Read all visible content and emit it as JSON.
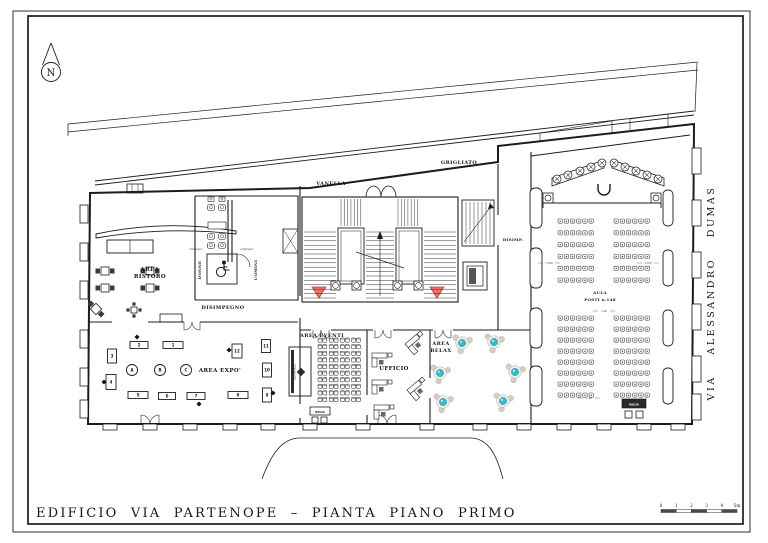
{
  "page": {
    "title": "EDIFICIO VIA PARTENOPE – PIANTA PIANO PRIMO",
    "street": "VIA ALESSANDRO DUMAS",
    "north": "N",
    "scale_ticks": [
      "0",
      "1",
      "2",
      "3",
      "4",
      "5m"
    ]
  },
  "labels": {
    "vanella": "VANELLA",
    "grigliato": "GRIGLIATO",
    "area_ristoro_1": "AREA",
    "area_ristoro_2": "RISTORO",
    "disimpegno": "DISIMPEGNO",
    "donne": "DONNE",
    "uomini": "UOMINI",
    "antibagno_l": "antibagno",
    "antibagno_r": "antibagno",
    "area_expo": "AREA EXPO'",
    "area_eventi": "AREA EVENTI",
    "ufficio": "UFFICIO",
    "area_relax_1": "AREA",
    "area_relax_2": "RELAX",
    "aula_1": "AULA",
    "aula_2": "POSTI  n.148",
    "disimp": "DISIMP.",
    "ledwall": "LEDWALL",
    "regia_eventi": "REGIA",
    "regia_aula": "REGIA"
  },
  "colors": {
    "ink": "#1c1c1c",
    "red": "#ee7566",
    "red_stroke": "#b8443a",
    "teal": "#3cb6c8",
    "teal_dark": "#2e98a8",
    "chair": "#d7cebc",
    "chair_stroke": "#b9ae97",
    "dark_fill": "#3a3a3a"
  },
  "plan": {
    "expo_stands": [
      {
        "n": "1",
        "x": 173,
        "y": 345,
        "w": 20,
        "h": 7
      },
      {
        "n": "2",
        "x": 139,
        "y": 345,
        "w": 18,
        "h": 7
      },
      {
        "n": "3",
        "x": 112,
        "y": 356,
        "w": 9,
        "h": 14
      },
      {
        "n": "4",
        "x": 111,
        "y": 382,
        "w": 10,
        "h": 15
      },
      {
        "n": "5",
        "x": 138,
        "y": 395,
        "w": 20,
        "h": 7
      },
      {
        "n": "6",
        "x": 167,
        "y": 396,
        "w": 17,
        "h": 7
      },
      {
        "n": "7",
        "x": 196,
        "y": 396,
        "w": 18,
        "h": 7
      },
      {
        "n": "8",
        "x": 238,
        "y": 395,
        "w": 20,
        "h": 7
      },
      {
        "n": "9",
        "x": 267,
        "y": 395,
        "w": 9,
        "h": 14
      },
      {
        "n": "10",
        "x": 267,
        "y": 370,
        "w": 9,
        "h": 14
      },
      {
        "n": "11",
        "x": 266,
        "y": 346,
        "w": 9,
        "h": 13
      },
      {
        "n": "12",
        "x": 237,
        "y": 351,
        "w": 10,
        "h": 14
      }
    ],
    "expo_letters": [
      {
        "n": "A",
        "x": 132,
        "y": 370
      },
      {
        "n": "B",
        "x": 160,
        "y": 370
      },
      {
        "n": "C",
        "x": 186,
        "y": 370
      }
    ],
    "markers": [
      [
        137,
        337
      ],
      [
        104,
        382
      ],
      [
        199,
        404
      ],
      [
        229,
        350
      ],
      [
        273,
        393
      ]
    ],
    "ristoro_tables": [
      [
        105,
        271
      ],
      [
        105,
        288
      ],
      [
        150,
        271
      ],
      [
        150,
        288
      ]
    ],
    "ristoro_diamond": [
      96,
      309
    ],
    "ristoro_small": [
      134,
      310
    ],
    "relax_tables": [
      [
        462,
        343
      ],
      [
        494,
        342
      ],
      [
        440,
        373
      ],
      [
        515,
        372
      ],
      [
        443,
        402
      ],
      [
        503,
        401
      ]
    ],
    "stage_seats": [
      [
        557,
        179
      ],
      [
        568,
        175
      ],
      [
        580,
        171
      ],
      [
        591,
        167
      ],
      [
        602,
        163
      ],
      [
        614,
        163
      ],
      [
        625,
        167
      ],
      [
        636,
        171
      ],
      [
        647,
        175
      ],
      [
        658,
        179
      ]
    ],
    "desks": [
      {
        "x": 372,
        "y": 353,
        "r": 0
      },
      {
        "x": 372,
        "y": 380,
        "r": 0
      },
      {
        "x": 374,
        "y": 405,
        "r": 0
      },
      {
        "x": 405,
        "y": 344,
        "r": -40
      },
      {
        "x": 407,
        "y": 390,
        "r": -40
      }
    ],
    "aula_seat_blocks": [
      {
        "x": 558,
        "y": 219,
        "cols": 6,
        "rows": 6,
        "dx": 6.2,
        "dy": 11.8
      },
      {
        "x": 614,
        "y": 219,
        "cols": 6,
        "rows": 6,
        "dx": 6.2,
        "dy": 11.8
      },
      {
        "x": 558,
        "y": 316,
        "cols": 6,
        "rows": 8,
        "dx": 6.2,
        "dy": 11
      },
      {
        "x": 614,
        "y": 316,
        "cols": 6,
        "rows": 8,
        "dx": 6.2,
        "dy": 11
      }
    ],
    "eventi_grid": {
      "x": 318,
      "y": 338,
      "cols": 8,
      "rows": 10,
      "dx": 4.8,
      "dy": 6.6,
      "pair_gap": 1.6
    },
    "wc_toilets": [
      [
        211,
        207
      ],
      [
        222,
        207
      ],
      [
        211,
        236
      ],
      [
        222,
        236
      ],
      [
        211,
        245
      ],
      [
        222,
        245
      ]
    ],
    "wc_sinks": [
      [
        211,
        199
      ],
      [
        222,
        199
      ]
    ],
    "doors": [
      {
        "c": 150,
        "y": 424,
        "r": 9,
        "d": -1
      },
      {
        "c": 387,
        "y": 424,
        "r": 9,
        "d": -1
      },
      {
        "c": 321,
        "y": 330,
        "r": 8,
        "d": 1
      },
      {
        "c": 383,
        "y": 330,
        "r": 8,
        "d": 1
      },
      {
        "c": 443,
        "y": 330,
        "r": 8,
        "d": 1
      },
      {
        "c": 192,
        "y": 322,
        "r": 8,
        "d": 1
      }
    ],
    "dims": [
      {
        "t": "1.700",
        "x": 549,
        "y": 264
      },
      {
        "t": "1.700",
        "x": 648,
        "y": 264
      },
      {
        "t": "1.20",
        "x": 604,
        "y": 312
      },
      {
        "t": "1.40",
        "x": 589,
        "y": 399
      }
    ],
    "pilasters": {
      "bottom_x": [
        110,
        150,
        190,
        230,
        268,
        310,
        363,
        427,
        480,
        524,
        564,
        604,
        644,
        678
      ],
      "left_y": [
        205,
        243,
        281,
        330,
        368,
        400
      ],
      "right_y": [
        148,
        200,
        252,
        304,
        356,
        394
      ],
      "aula_west_y": [
        188,
        248,
        308,
        366
      ],
      "aula_east_y": [
        190,
        250,
        310,
        368
      ]
    }
  }
}
